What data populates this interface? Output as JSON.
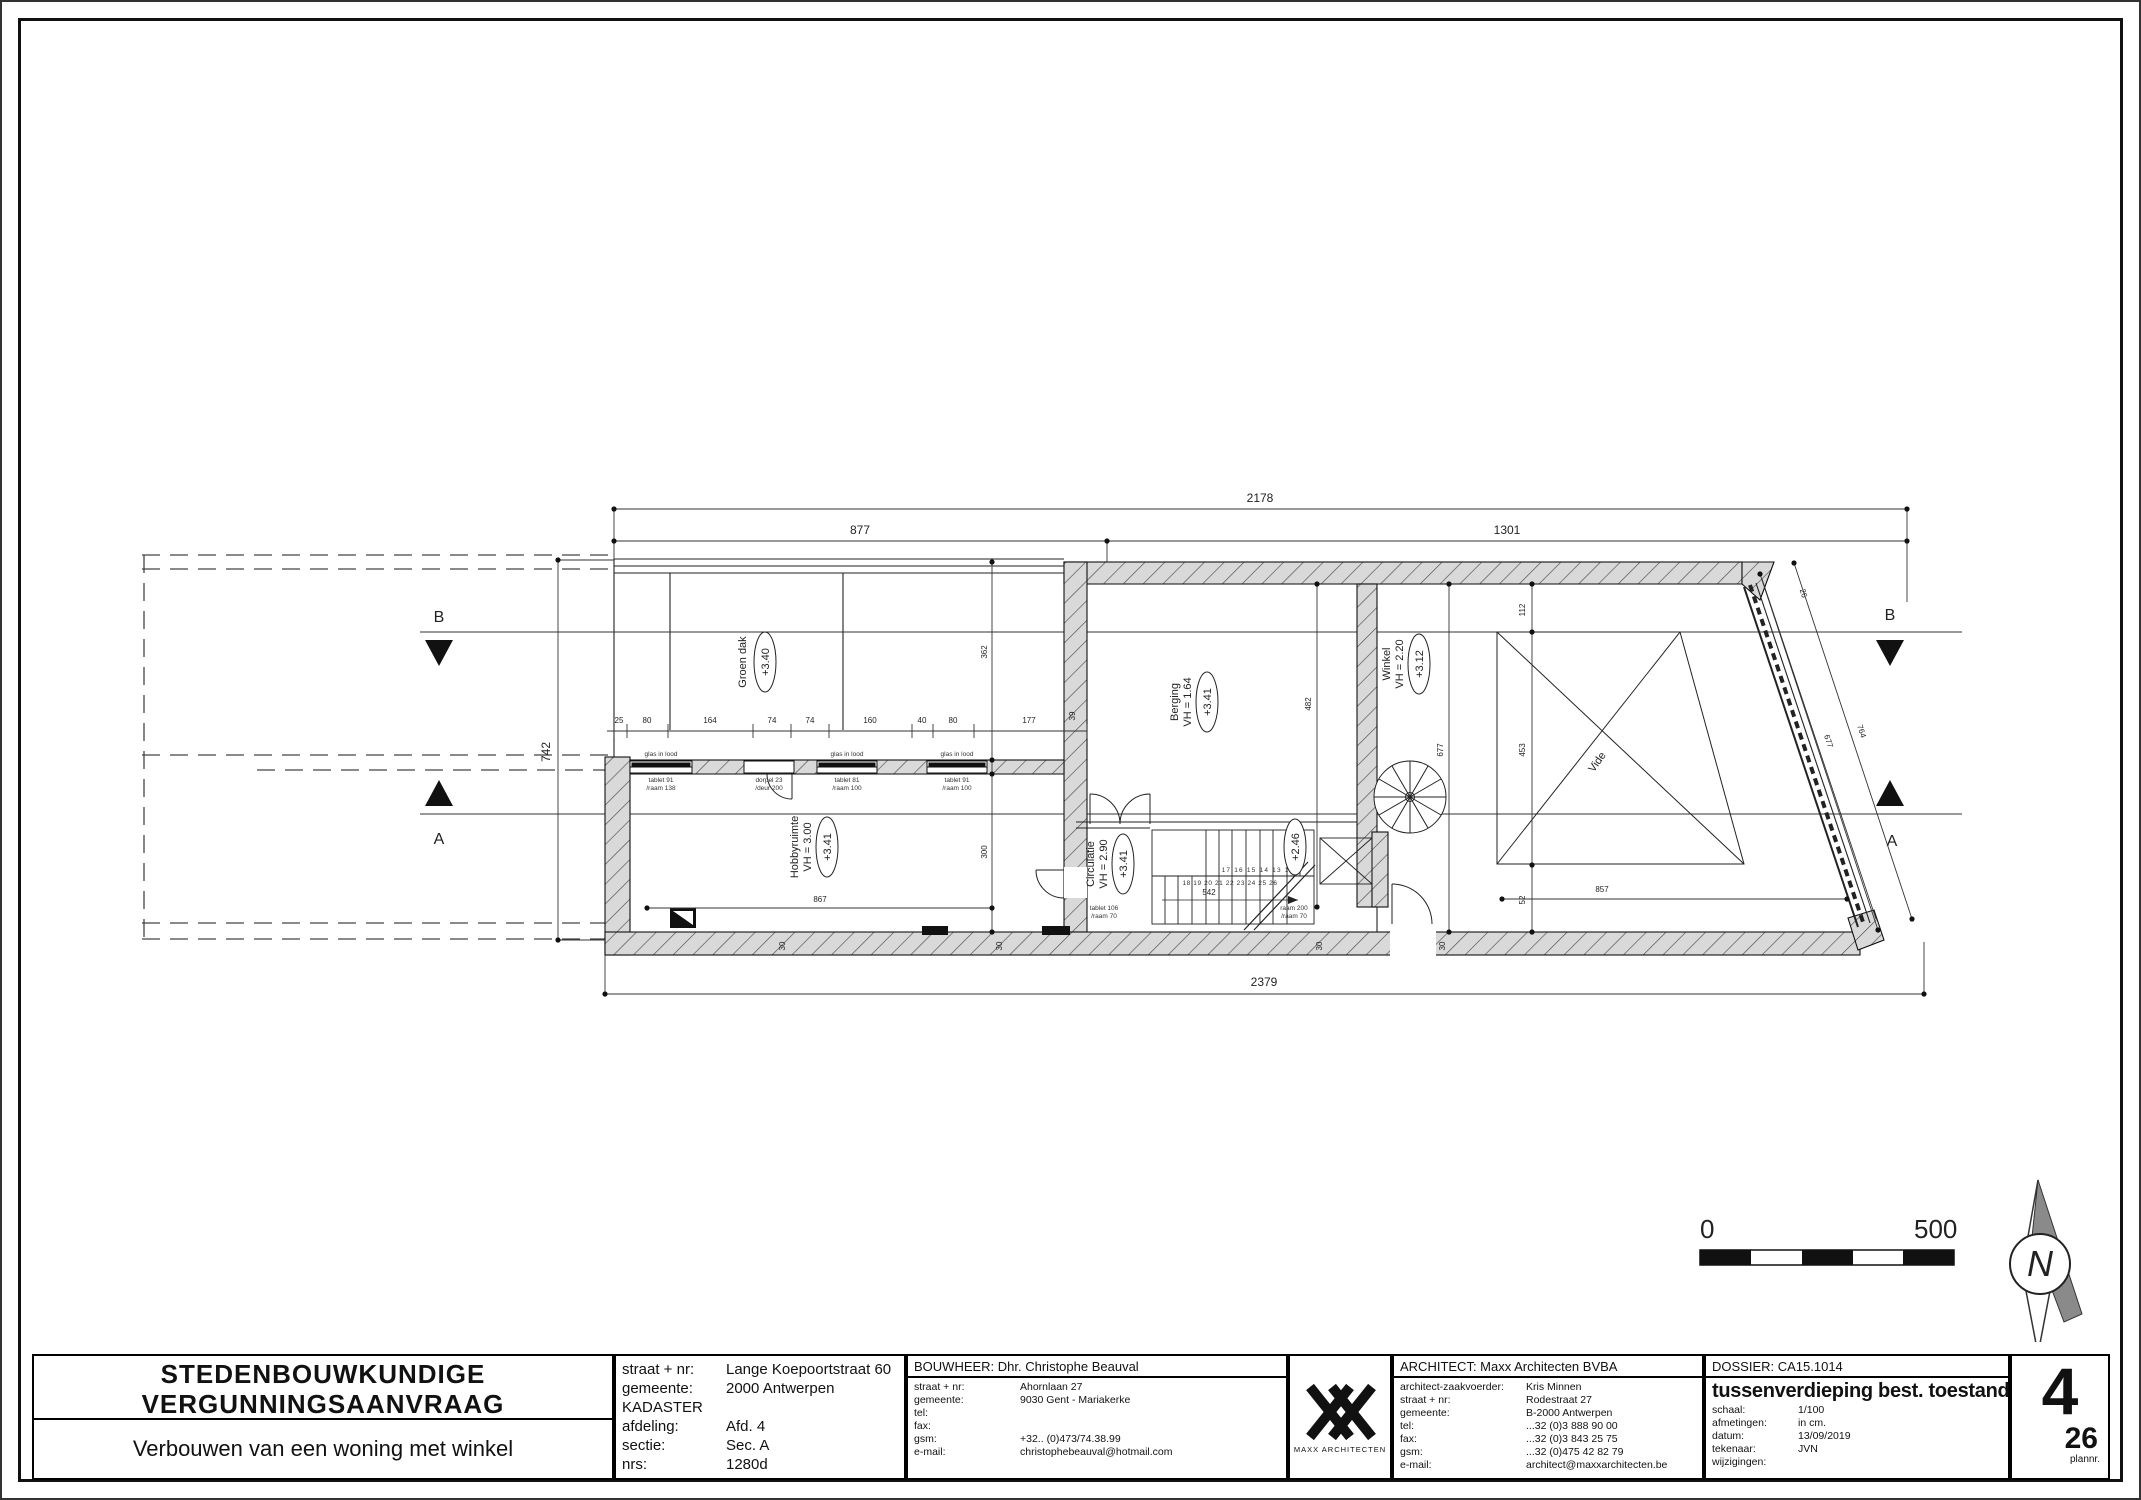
{
  "sheet": {
    "number": "4",
    "total": "26",
    "plannr_label": "plannr."
  },
  "title_block": {
    "application": {
      "line1": "STEDENBOUWKUNDIGE",
      "line2": "VERGUNNINGSAANVRAAG",
      "subtitle": "Verbouwen van een woning met winkel"
    },
    "site": {
      "rows": [
        {
          "label": "straat + nr:",
          "value": "Lange Koepoortstraat 60"
        },
        {
          "label": "gemeente:",
          "value": "2000 Antwerpen"
        },
        {
          "label": "KADASTER",
          "value": ""
        },
        {
          "label": "afdeling:",
          "value": "Afd. 4"
        },
        {
          "label": "sectie:",
          "value": "Sec. A"
        },
        {
          "label": "nrs:",
          "value": "1280d"
        }
      ]
    },
    "bouwheer": {
      "header": "BOUWHEER:  Dhr. Christophe Beauval",
      "rows": [
        {
          "label": "straat + nr:",
          "value": "Ahornlaan 27"
        },
        {
          "label": "gemeente:",
          "value": "9030 Gent - Mariakerke"
        },
        {
          "label": "tel:",
          "value": ""
        },
        {
          "label": "fax:",
          "value": ""
        },
        {
          "label": "gsm:",
          "value": "+32.. (0)473/74.38.99"
        },
        {
          "label": "e-mail:",
          "value": "christophebeauval@hotmail.com"
        }
      ]
    },
    "logo": {
      "caption": "MAXX ARCHITECTEN"
    },
    "architect": {
      "header": "ARCHITECT: Maxx Architecten BVBA",
      "rows": [
        {
          "label": "architect-zaakvoerder:",
          "value": "Kris Minnen"
        },
        {
          "label": "straat + nr:",
          "value": "Rodestraat 27"
        },
        {
          "label": "gemeente:",
          "value": "B-2000 Antwerpen"
        },
        {
          "label": "tel:",
          "value": "...32 (0)3 888 90 00"
        },
        {
          "label": "fax:",
          "value": "...32 (0)3 843 25 75"
        },
        {
          "label": "gsm:",
          "value": "...32 (0)475 42 82 79"
        },
        {
          "label": "e-mail:",
          "value": "architect@maxxarchitecten.be"
        }
      ]
    },
    "dossier": {
      "header": "DOSSIER: CA15.1014",
      "title": "tussenverdieping best. toestand",
      "rows": [
        {
          "label": "schaal:",
          "value": "1/100"
        },
        {
          "label": "afmetingen:",
          "value": "in cm."
        },
        {
          "label": "datum:",
          "value": "13/09/2019"
        },
        {
          "label": "tekenaar:",
          "value": "JVN"
        },
        {
          "label": "wijzigingen:",
          "value": ""
        }
      ]
    }
  },
  "plan": {
    "rooms": {
      "groen_dak": {
        "name": "Groen dak",
        "level": "+3.40"
      },
      "berging": {
        "name": "Berging",
        "vh": "VH = 1.64",
        "level": "+3.41"
      },
      "winkel": {
        "name": "Winkel",
        "vh": "VH = 2.20",
        "level": "+3.12"
      },
      "hobby": {
        "name": "Hobbyruimte",
        "vh": "VH = 3.00",
        "level": "+3.41"
      },
      "circulatie": {
        "name": "Circulatie",
        "vh": "VH = 2.90",
        "level": "+3.41"
      },
      "vide": {
        "name": "Vide"
      }
    },
    "levels": {
      "stair": "+2.46"
    },
    "labels": {
      "glas": "glas in lood",
      "w1a": "tablet 91",
      "w1b": "/raam 138",
      "w2a": "dorpel 23",
      "w2b": "/deur 200",
      "w3a": "tablet 81",
      "w3b": "/raam 100",
      "w4a": "tablet 91",
      "w4b": "/raam 100",
      "s1a": "tablet 106",
      "s1b": "/raam 70",
      "s2a": "raam 200",
      "s2b": "/raam 70",
      "treads_upper": "17 16 15 14 13 12",
      "treads_lower": "18 19 20 21 22 23 24 25 26",
      "treads_mid": "542"
    },
    "markers": {
      "a": "A",
      "b": "B"
    },
    "dims": {
      "total": "2178",
      "left": "877",
      "right": "1301",
      "bottom": "2379",
      "height": "742",
      "chain": [
        "25",
        "80",
        "164",
        "74",
        "74",
        "160",
        "40",
        "80",
        "177"
      ],
      "wall39": "39",
      "v362": "362",
      "v300": "300",
      "v482": "482",
      "v677": "677",
      "v112": "112",
      "v453": "453",
      "v52": "52",
      "h867": "867",
      "h857": "857",
      "diag677": "677",
      "diag764": "764",
      "diag26": "26",
      "t30": "30"
    }
  },
  "scale_bar": {
    "start": "0",
    "end": "500"
  },
  "north": {
    "label": "N"
  }
}
